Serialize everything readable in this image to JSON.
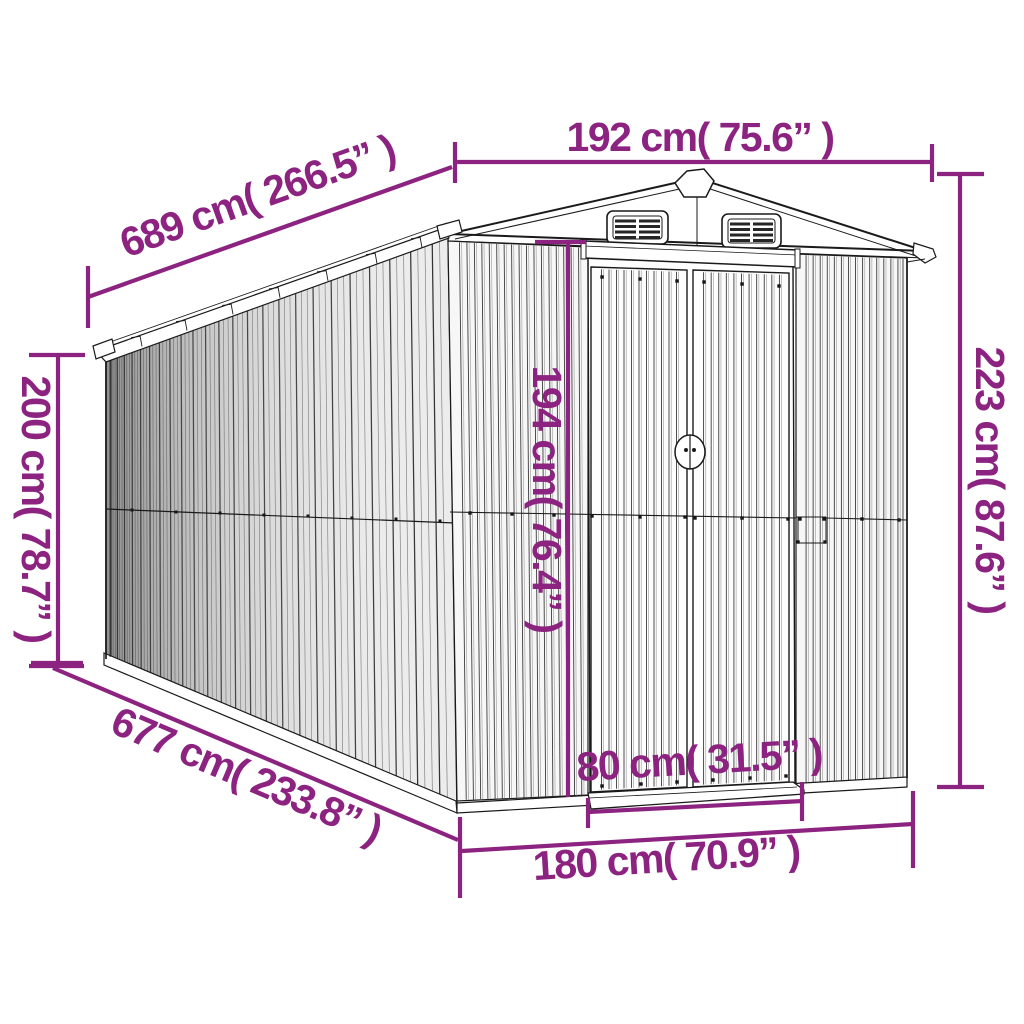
{
  "diagram": {
    "subject": "garden shed line drawing with dimension annotations"
  },
  "colors": {
    "accent": "#8d2380",
    "line": "#1a1a1a"
  },
  "dimensions": {
    "top_width": {
      "value_cm": 192,
      "value_in": 75.6,
      "label": "192 cm( 75.6” )"
    },
    "side_length": {
      "value_cm": 689,
      "value_in": 266.5,
      "label": "689 cm( 266.5” )"
    },
    "left_height": {
      "value_cm": 200,
      "value_in": 78.7,
      "label": "200 cm( 78.7” )"
    },
    "right_height": {
      "value_cm": 223,
      "value_in": 87.6,
      "label": "223 cm( 87.6” )"
    },
    "door_height": {
      "value_cm": 194,
      "value_in": 76.4,
      "label": "194 cm( 76.4” )"
    },
    "base_length": {
      "value_cm": 677,
      "value_in": 233.8,
      "label": "677 cm( 233.8” )"
    },
    "door_width": {
      "value_cm": 80,
      "value_in": 31.5,
      "label": "80 cm( 31.5” )"
    },
    "base_width": {
      "value_cm": 180,
      "value_in": 70.9,
      "label": "180 cm( 70.9” )"
    }
  }
}
